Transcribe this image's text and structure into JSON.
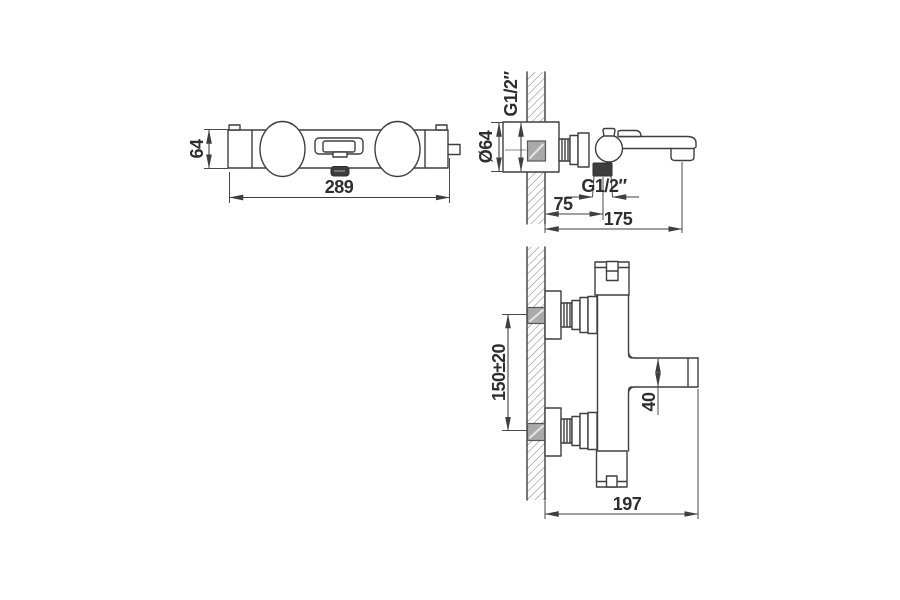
{
  "drawing": {
    "front_view": {
      "height_label": "64",
      "width_label": "289"
    },
    "side_view": {
      "wall_thread_label": "G1/2″",
      "flange_diameter_label": "Ø64",
      "outlet_thread_label": "G1/2″",
      "wall_to_outlet_label": "75",
      "wall_to_spout_label": "175"
    },
    "plan_view": {
      "inlet_spacing_label": "150±20",
      "spout_width_label": "40",
      "depth_label": "197"
    }
  }
}
